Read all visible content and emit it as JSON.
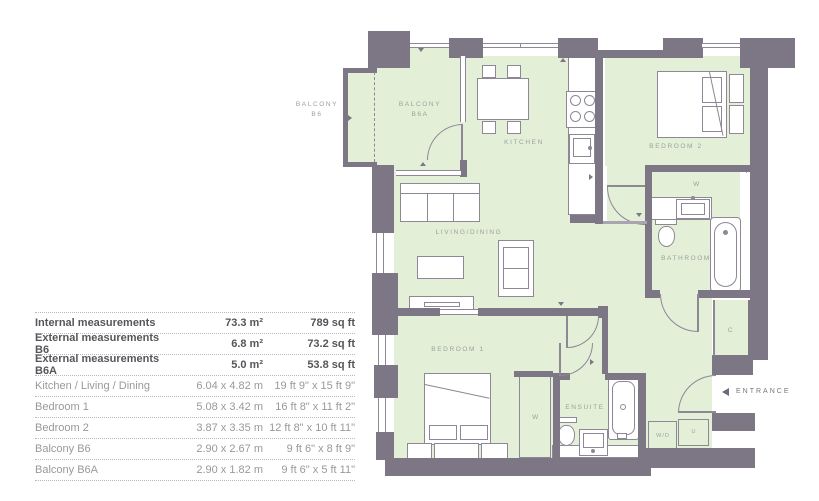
{
  "colors": {
    "wall": "#7d7685",
    "floor_green": "#e4efd8",
    "furniture_line": "#8d8796",
    "label_gray": "#9aa29b",
    "table_bold_text": "#54565a",
    "table_text": "#97999b"
  },
  "plan": {
    "labels": {
      "balcony_b6_l1": "BALCONY",
      "balcony_b6_l2": "B6",
      "balcony_b6a_l1": "BALCONY",
      "balcony_b6a_l2": "B6A",
      "kitchen": "KITCHEN",
      "bedroom2": "BEDROOM 2",
      "living_dining": "LIVING/DINING",
      "wardrobe_bedroom2": "W",
      "bathroom": "BATHROOM",
      "closet": "C",
      "bedroom1": "BEDROOM 1",
      "wardrobe_bedroom1": "W",
      "ensuite": "ENSUITE",
      "washer_dryer": "W/D",
      "utility": "U",
      "entrance": "ENTRANCE"
    }
  },
  "table": {
    "rows": [
      {
        "label": "Internal measurements",
        "metric": "73.3 m²",
        "imperial": "789 sq ft"
      },
      {
        "label": "External measurements B6",
        "metric": "6.8 m²",
        "imperial": "73.2 sq ft"
      },
      {
        "label": "External measurements B6A",
        "metric": "5.0 m²",
        "imperial": "53.8 sq ft"
      },
      {
        "label": "Kitchen / Living / Dining",
        "metric": "6.04 x 4.82 m",
        "imperial": "19 ft 9\" x 15 ft 9\""
      },
      {
        "label": "Bedroom 1",
        "metric": "5.08 x 3.42 m",
        "imperial": "16 ft 8\" x 11 ft 2\""
      },
      {
        "label": "Bedroom 2",
        "metric": "3.87 x 3.35 m",
        "imperial": "12 ft 8\" x 10 ft 11\""
      },
      {
        "label": "Balcony B6",
        "metric": "2.90 x 2.67 m",
        "imperial": "9 ft 6\" x 8 ft 9\""
      },
      {
        "label": "Balcony B6A",
        "metric": "2.90 x 1.82 m",
        "imperial": "9 ft 6\" x 5 ft 11\""
      }
    ]
  }
}
